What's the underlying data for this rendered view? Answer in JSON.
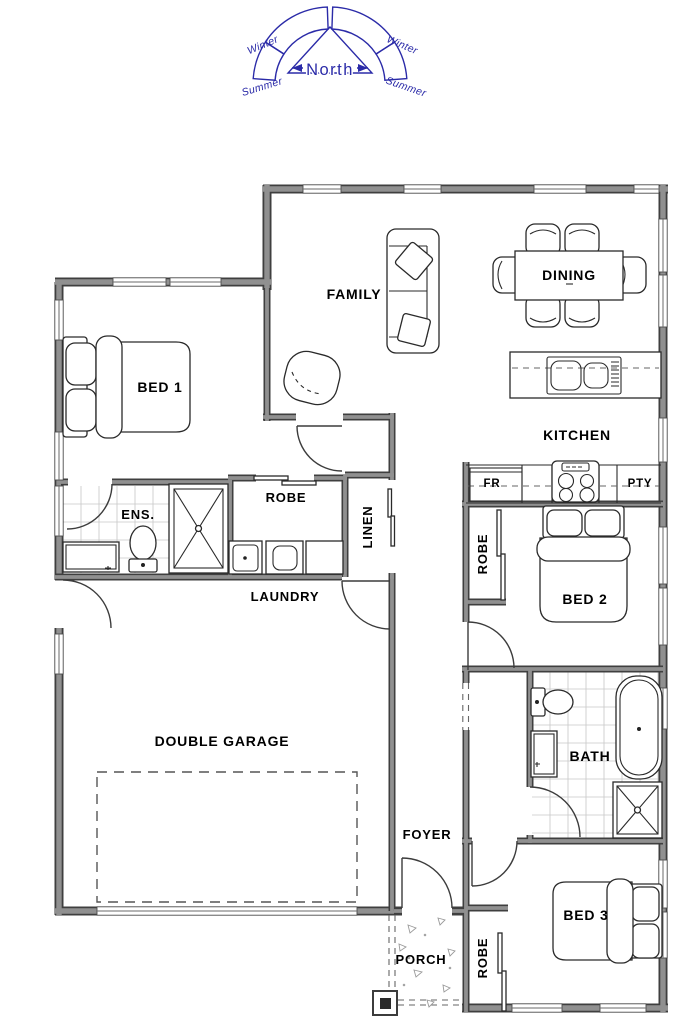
{
  "compass": {
    "north": "North",
    "winter": "Winter",
    "summer": "Summer"
  },
  "rooms": {
    "family": "FAMILY",
    "dining": "DINING",
    "kitchen": "KITCHEN",
    "fridge": "FR",
    "pantry": "PTY",
    "bed1": "BED 1",
    "ens": "ENS.",
    "robe1": "ROBE",
    "linen": "LINEN",
    "laundry": "LAUNDRY",
    "robe2": "ROBE",
    "bed2": "BED 2",
    "garage": "DOUBLE GARAGE",
    "bath": "BATH",
    "foyer": "FOYER",
    "bed3": "BED 3",
    "robe3": "ROBE",
    "porch": "PORCH"
  },
  "colors": {
    "compass_blue": "#2b2ba8",
    "compass_fill": "#d9e6f2",
    "wall_dark": "#3f3f3f",
    "wall_light": "#909090",
    "tile": "#c7c7c7",
    "text": "#000000"
  }
}
